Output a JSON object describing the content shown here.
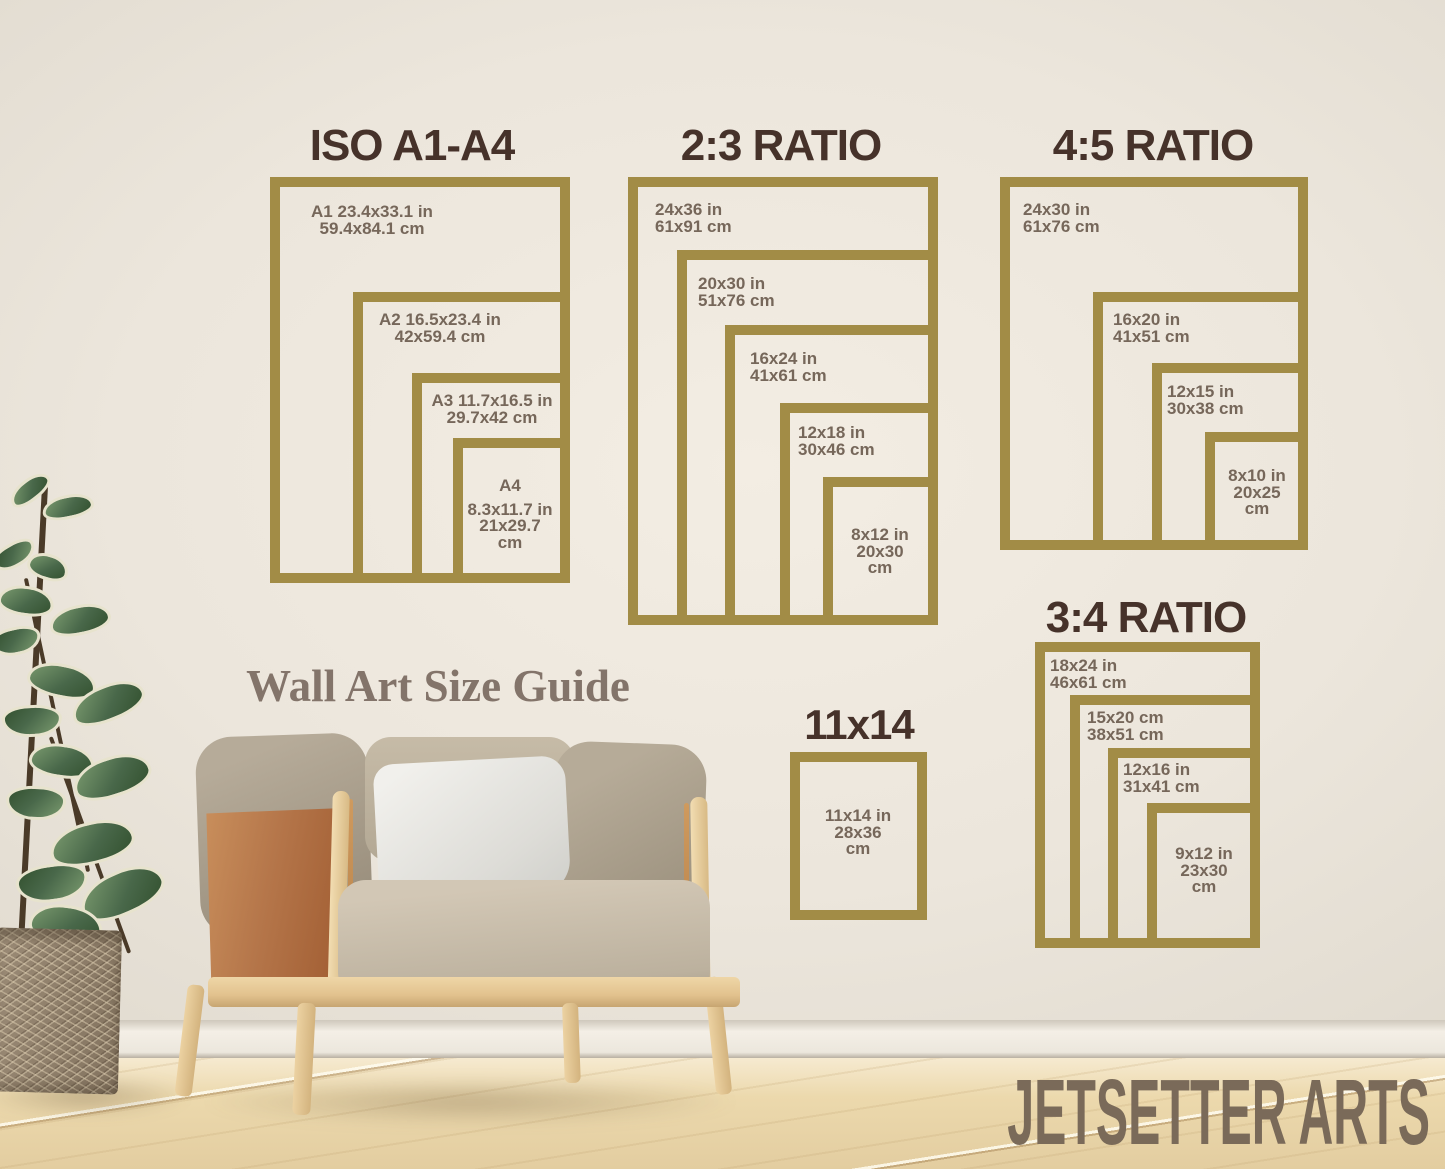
{
  "brand": "JETSETTER ARTS",
  "watermark": "Wall Art Size Guide",
  "colors": {
    "frame_gold": "#a28c46",
    "title_brown": "#46322a",
    "label_brown": "#76675a",
    "wall_beige": "#e8e2d8",
    "brand_brown": "#7a6a59"
  },
  "groups": [
    {
      "title": "ISO A1-A4",
      "frames": [
        {
          "lines": [
            "A1 23.4x33.1 in",
            "59.4x84.1 cm"
          ]
        },
        {
          "lines": [
            "A2 16.5x23.4 in",
            "42x59.4 cm"
          ]
        },
        {
          "lines": [
            "A3 11.7x16.5 in",
            "29.7x42 cm"
          ]
        },
        {
          "lines": [
            "A4",
            "8.3x11.7 in",
            "21x29.7",
            "cm"
          ]
        }
      ]
    },
    {
      "title": "2:3 RATIO",
      "frames": [
        {
          "lines": [
            "24x36 in",
            "61x91 cm"
          ]
        },
        {
          "lines": [
            "20x30 in",
            "51x76 cm"
          ]
        },
        {
          "lines": [
            "16x24 in",
            "41x61 cm"
          ]
        },
        {
          "lines": [
            "12x18 in",
            "30x46 cm"
          ]
        },
        {
          "lines": [
            "8x12 in",
            "20x30",
            "cm"
          ]
        }
      ]
    },
    {
      "title": "4:5 RATIO",
      "frames": [
        {
          "lines": [
            "24x30 in",
            "61x76 cm"
          ]
        },
        {
          "lines": [
            "16x20 in",
            "41x51 cm"
          ]
        },
        {
          "lines": [
            "12x15 in",
            "30x38 cm"
          ]
        },
        {
          "lines": [
            "8x10 in",
            "20x25",
            "cm"
          ]
        }
      ]
    },
    {
      "title": "3:4 RATIO",
      "frames": [
        {
          "lines": [
            "18x24 in",
            "46x61 cm"
          ]
        },
        {
          "lines": [
            "15x20 cm",
            "38x51 cm"
          ]
        },
        {
          "lines": [
            "12x16 in",
            "31x41 cm"
          ]
        },
        {
          "lines": [
            "9x12 in",
            "23x30",
            "cm"
          ]
        }
      ]
    },
    {
      "title": "11x14",
      "frames": [
        {
          "lines": [
            "11x14 in",
            "28x36",
            "cm"
          ]
        }
      ]
    }
  ]
}
